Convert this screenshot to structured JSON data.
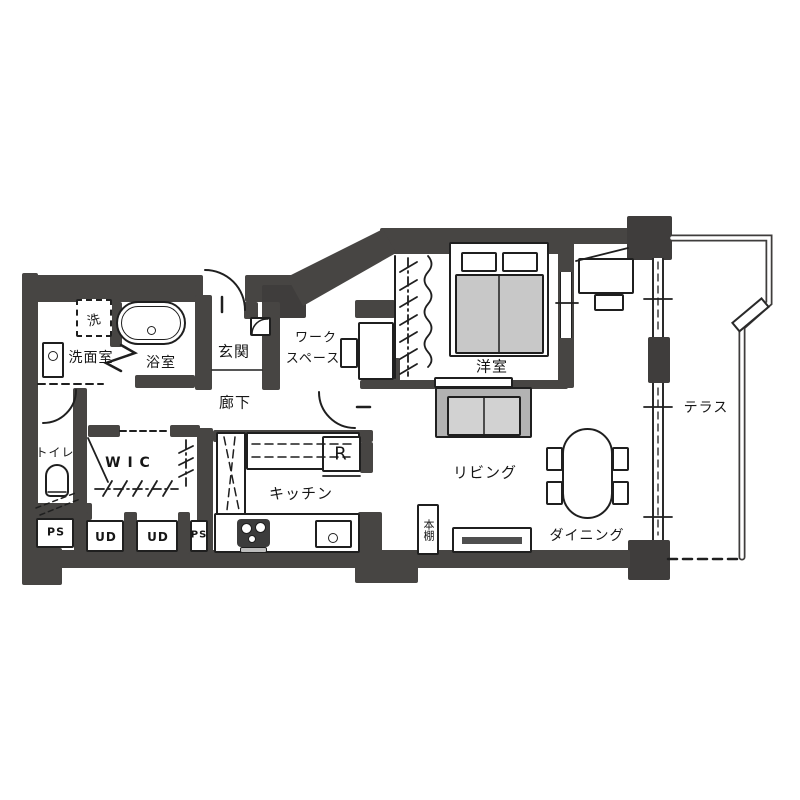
{
  "labels": {
    "washroom": "洗面室",
    "bathroom": "浴室",
    "entrance": "玄関",
    "workspace_line1": "ワーク",
    "workspace_line2": "スペース",
    "bedroom": "洋室",
    "hallway": "廊下",
    "toilet": "トイレ",
    "wic": "W I C",
    "kitchen": "キッチン",
    "living": "リビング",
    "dining": "ダイニング",
    "terrace": "テラス",
    "ps_left": "PS",
    "ud_left": "UD",
    "ud_right": "UD",
    "ps_right": "PS",
    "bookshelf": "本棚",
    "refrigerator": "R",
    "washer": "洗"
  },
  "colors": {
    "wall": "#474543",
    "pillar": "#3f3d3c",
    "line": "#1f1f1f",
    "furniture_gray": "#c8c8c8",
    "sofa_outer": "#b2b2b2",
    "sofa_inner": "#d2d2d2",
    "paper": "#ffffff"
  }
}
